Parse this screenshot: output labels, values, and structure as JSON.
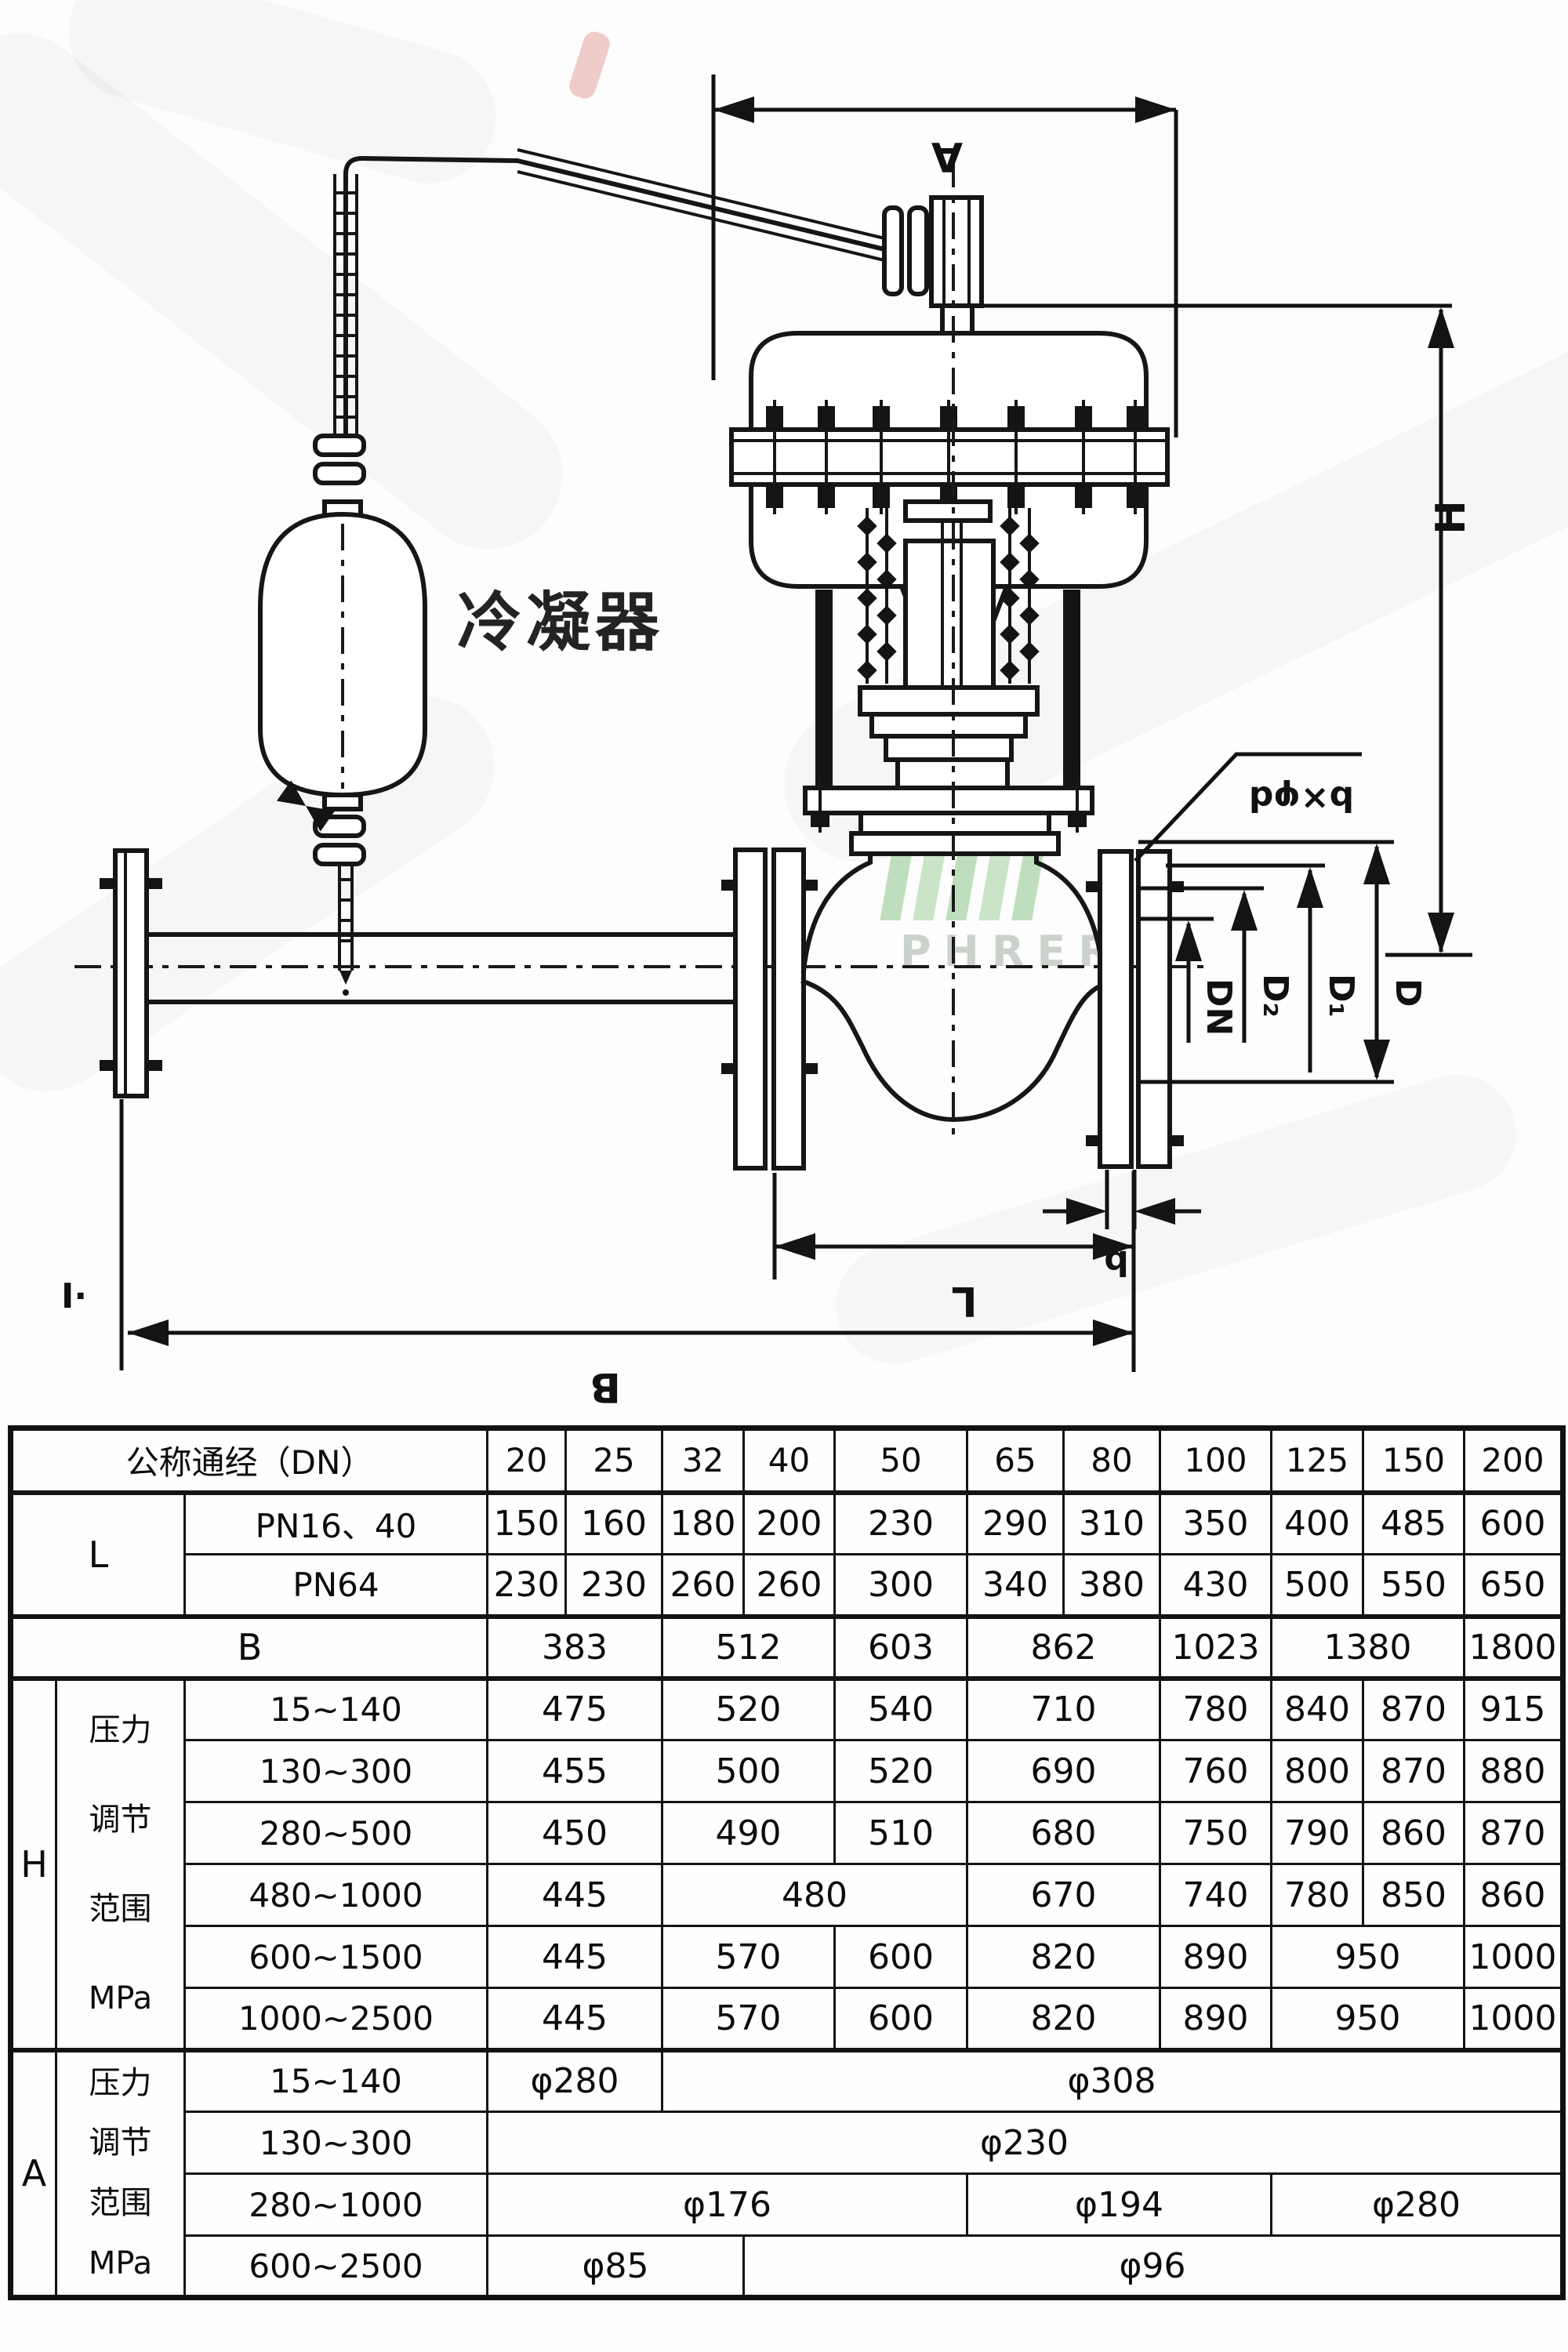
{
  "diagram": {
    "condenser_label": "冷凝器",
    "labels": {
      "A": "A",
      "H": "H",
      "L": "L",
      "B": "B",
      "b": "b",
      "bxd": "b×φd",
      "DN": "DN",
      "D2": "D₂",
      "D1": "D₁",
      "D": "D",
      "section_mark": "I·"
    },
    "watermark": {
      "letters": "PHRER",
      "bar_color": "#b5d9b2",
      "letter_color": "#c3cac3"
    }
  },
  "table": {
    "header": {
      "label": "公称通经（DN）",
      "dn": [
        "20",
        "25",
        "32",
        "40",
        "50",
        "65",
        "80",
        "100",
        "125",
        "150",
        "200"
      ]
    },
    "body": [
      {
        "name": "L-PN16-40",
        "cells": [
          [
            "L",
            2,
            2,
            "big"
          ],
          [
            "PN16、40",
            1,
            1,
            "rng"
          ],
          [
            "150"
          ],
          [
            "160"
          ],
          [
            "180"
          ],
          [
            "200"
          ],
          [
            "230"
          ],
          [
            "290"
          ],
          [
            "310"
          ],
          [
            "350"
          ],
          [
            "400"
          ],
          [
            "485"
          ],
          [
            "600"
          ]
        ]
      },
      {
        "name": "L-PN64",
        "cells": [
          [
            "PN64",
            1,
            1,
            "rng"
          ],
          [
            "230"
          ],
          [
            "230"
          ],
          [
            "260"
          ],
          [
            "260"
          ],
          [
            "300"
          ],
          [
            "340"
          ],
          [
            "380"
          ],
          [
            "430"
          ],
          [
            "500"
          ],
          [
            "550"
          ],
          [
            "650"
          ]
        ]
      },
      {
        "name": "B",
        "sep": true,
        "cells": [
          [
            "B",
            3,
            1,
            "big"
          ],
          [
            "383",
            2
          ],
          [
            "512",
            2
          ],
          [
            "603"
          ],
          [
            "862",
            2
          ],
          [
            "1023"
          ],
          [
            "1380",
            2
          ],
          [
            "1800"
          ]
        ]
      },
      {
        "name": "H-15-140",
        "sep": true,
        "cells": [
          [
            "H",
            1,
            6,
            "big"
          ],
          [
            "压力|调节|范围|MPa",
            1,
            6,
            "multi6"
          ],
          [
            "15~140",
            1,
            1,
            "rng"
          ],
          [
            "475",
            2
          ],
          [
            "520",
            2
          ],
          [
            "540"
          ],
          [
            "710",
            2
          ],
          [
            "780"
          ],
          [
            "840"
          ],
          [
            "870"
          ],
          [
            "915"
          ]
        ]
      },
      {
        "name": "H-130-300",
        "cells": [
          [
            "130~300",
            1,
            1,
            "rng"
          ],
          [
            "455",
            2
          ],
          [
            "500",
            2
          ],
          [
            "520"
          ],
          [
            "690",
            2
          ],
          [
            "760"
          ],
          [
            "800"
          ],
          [
            "870"
          ],
          [
            "880"
          ]
        ]
      },
      {
        "name": "H-280-500",
        "cells": [
          [
            "280~500",
            1,
            1,
            "rng"
          ],
          [
            "450",
            2
          ],
          [
            "490",
            2
          ],
          [
            "510"
          ],
          [
            "680",
            2
          ],
          [
            "750"
          ],
          [
            "790"
          ],
          [
            "860"
          ],
          [
            "870"
          ]
        ]
      },
      {
        "name": "H-480-1000",
        "cells": [
          [
            "480~1000",
            1,
            1,
            "rng"
          ],
          [
            "445",
            2
          ],
          [
            "480",
            3
          ],
          [
            "670",
            2
          ],
          [
            "740"
          ],
          [
            "780"
          ],
          [
            "850"
          ],
          [
            "860"
          ]
        ]
      },
      {
        "name": "H-600-1500",
        "cells": [
          [
            "600~1500",
            1,
            1,
            "rng"
          ],
          [
            "445",
            2
          ],
          [
            "570",
            2
          ],
          [
            "600"
          ],
          [
            "820",
            2
          ],
          [
            "890"
          ],
          [
            "950",
            2
          ],
          [
            "1000"
          ]
        ]
      },
      {
        "name": "H-1000-2500",
        "cells": [
          [
            "1000~2500",
            1,
            1,
            "rng"
          ],
          [
            "445",
            2
          ],
          [
            "570",
            2
          ],
          [
            "600"
          ],
          [
            "820",
            2
          ],
          [
            "890"
          ],
          [
            "950",
            2
          ],
          [
            "1000"
          ]
        ]
      },
      {
        "name": "A-15-140",
        "sep": true,
        "cells": [
          [
            "A",
            1,
            4,
            "big"
          ],
          [
            "压力|调节|范围|MPa",
            1,
            4,
            "multi4"
          ],
          [
            "15~140",
            1,
            1,
            "rng"
          ],
          [
            "φ280",
            2
          ],
          [
            "φ308",
            9
          ]
        ]
      },
      {
        "name": "A-130-300",
        "cells": [
          [
            "130~300",
            1,
            1,
            "rng"
          ],
          [
            "φ230",
            11
          ]
        ]
      },
      {
        "name": "A-280-1000",
        "cells": [
          [
            "280~1000",
            1,
            1,
            "rng"
          ],
          [
            "φ176",
            5
          ],
          [
            "φ194",
            3
          ],
          [
            "φ280",
            3
          ]
        ]
      },
      {
        "name": "A-600-2500",
        "cells": [
          [
            "600~2500",
            1,
            1,
            "rng"
          ],
          [
            "φ85",
            3
          ],
          [
            "φ96",
            8
          ]
        ]
      }
    ]
  }
}
